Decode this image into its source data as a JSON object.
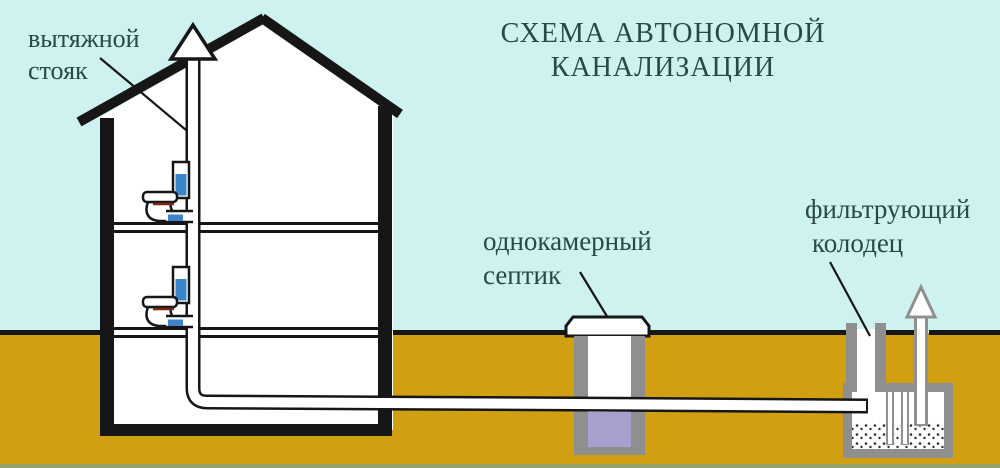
{
  "title": {
    "line1": "СХЕМА АВТОНОМНОЙ",
    "line2": "КАНАЛИЗАЦИИ"
  },
  "labels": {
    "vent_stack": {
      "line1": "вытяжной",
      "line2": "стояк"
    },
    "septic": {
      "line1": "однокамерный",
      "line2": "септик"
    },
    "well": {
      "line1": "фильтрующий",
      "line2": "колодец"
    }
  },
  "icons": {
    "vent_stack_arrow": "up-arrow",
    "well_vent_arrow": "up-arrow"
  },
  "colors": {
    "sky": "#cdf2ef",
    "ground": "#d1a012",
    "outline": "#161616",
    "text": "#2c4747",
    "white": "#ffffff",
    "concrete_gray": "#8f8f8f",
    "septic_liquid": "#a7a0ce",
    "water_blue": "#3c85c8",
    "seat_accent": "#7c2810",
    "bottom_strip": "#95a26b"
  }
}
